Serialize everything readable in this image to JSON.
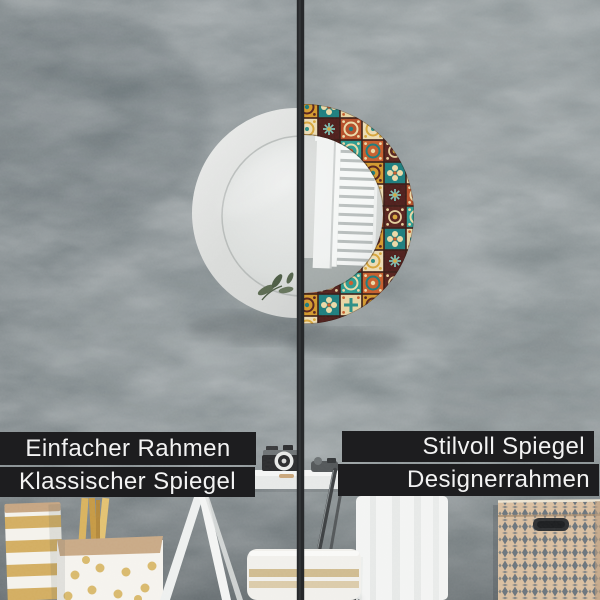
{
  "labels": {
    "left": {
      "line1": "Einfacher Rahmen",
      "line2": "Klassischer Spiegel"
    },
    "right": {
      "line1": "Stilvoll Spiegel",
      "line2": "Designerrahmen"
    }
  },
  "colors": {
    "label_bar_bg": "#1d1d1f",
    "label_text": "#f3f3f3",
    "wall_base": "#828b8e",
    "wall_right": "#9aa1a3",
    "divider": "#26282a",
    "mirror_frame_white": "#d7d9d7",
    "mirror_glass_left": "#d9dcda",
    "mirror_glass_right": "#d2d5d3",
    "tile_teal": "#2d9b90",
    "tile_teal_dark": "#1f7f7f",
    "tile_orange": "#c75f2e",
    "tile_orange_deep": "#b5502a",
    "tile_maroon": "#58241f",
    "tile_maroon_dark": "#4f201d",
    "tile_cream": "#e7d5a4",
    "tile_cream_light": "#ecdcb4",
    "tile_mustard": "#d39a2f",
    "basket_beige": "#d9bfa1",
    "basket_diamond": "#64707a",
    "gold_accent": "#d6b267",
    "towel_white": "#f3f4f3"
  }
}
